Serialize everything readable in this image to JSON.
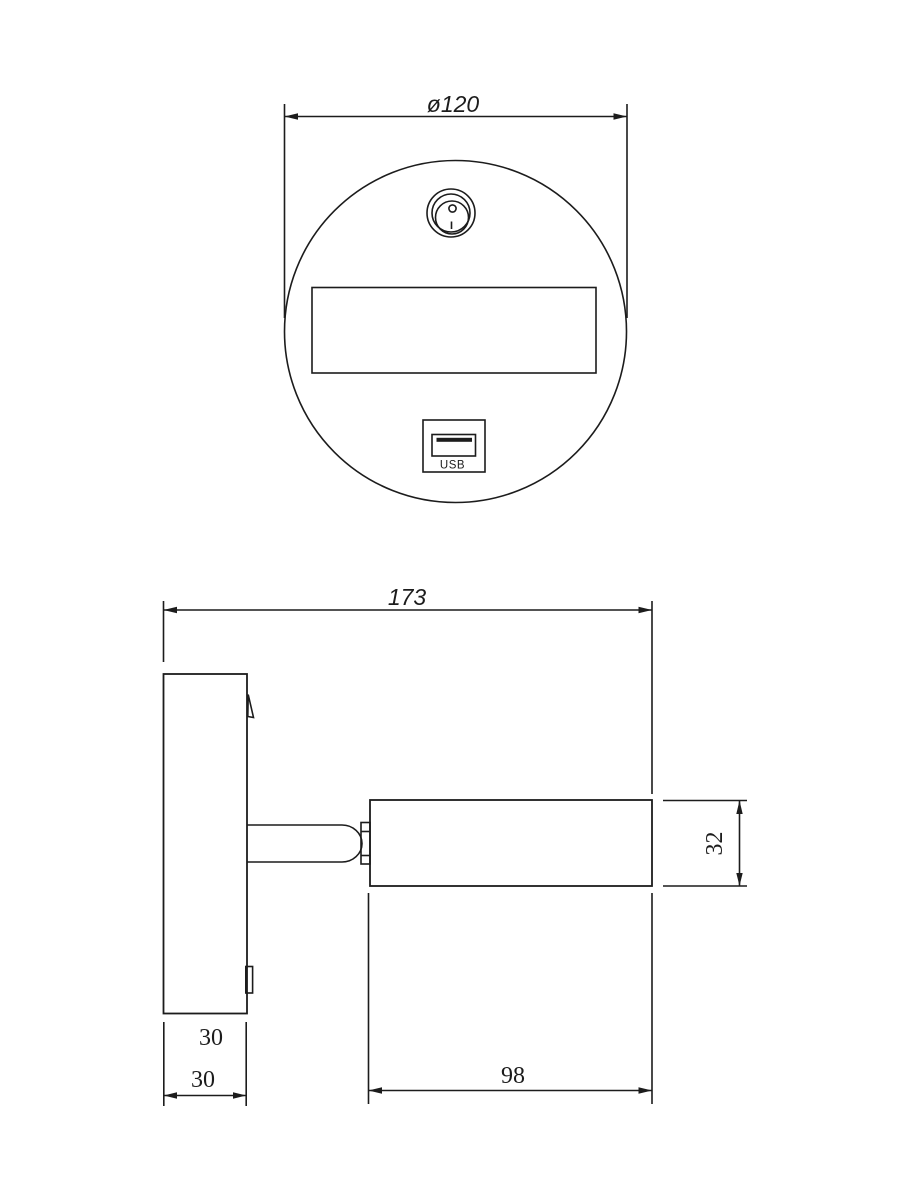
{
  "page": {
    "background_color": "#ffffff",
    "line_color": "#1c1c1c"
  },
  "front_view": {
    "name": "faceplate front view",
    "diameter_label": "ø120",
    "usb_label": "USB"
  },
  "side_view": {
    "name": "wall lamp side view",
    "overall_width_label": "173",
    "head_height_label": "32",
    "backplate_dim_label_upper": "30",
    "backplate_dim_label_lower": "30",
    "head_length_label": "98"
  }
}
